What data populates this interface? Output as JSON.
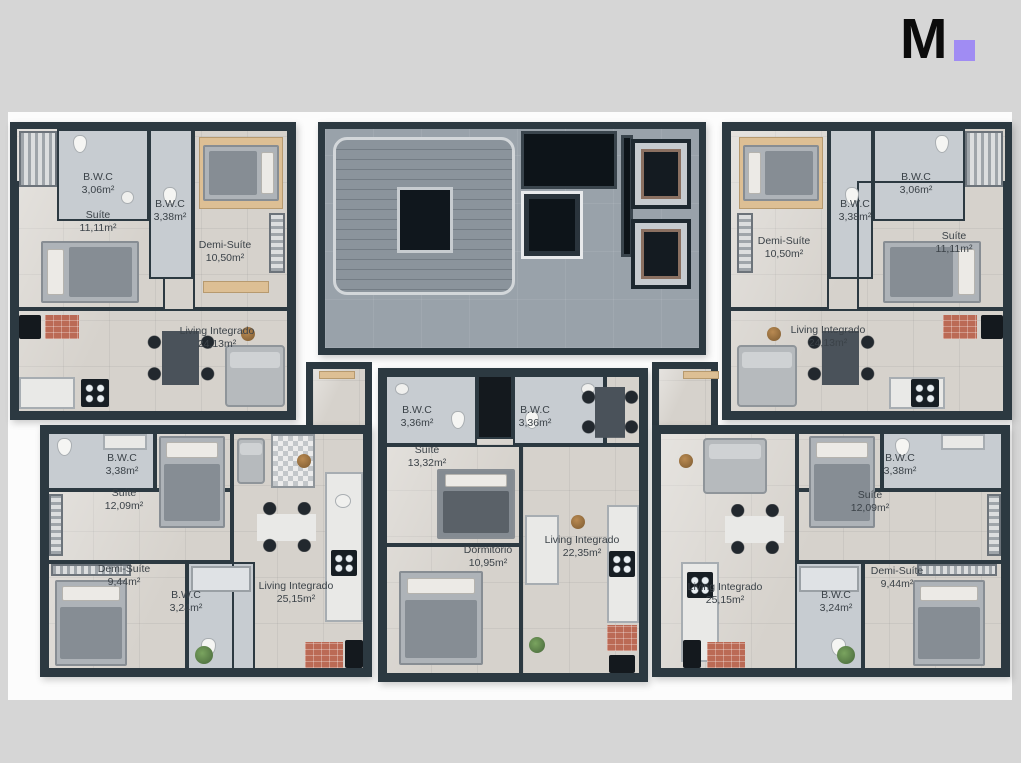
{
  "logo": {
    "letter": "M"
  },
  "theme": {
    "accent_purple": "#a08cf3",
    "wall": "#2c3941",
    "unit_floor": "#d6d2cc",
    "bath_floor": "#c7ccd1",
    "common_floor": "#99a2aa",
    "background": "#d6d6d6",
    "backdrop": "#fcfcfc",
    "label_text": "#3b4248"
  },
  "plan": {
    "units": {
      "top_left": {
        "rooms": {
          "suite": {
            "label": "Suíte",
            "area": "11,11m²"
          },
          "bwc_small": {
            "label": "B.W.C",
            "area": "3,06m²"
          },
          "bwc_large": {
            "label": "B.W.C",
            "area": "3,38m²"
          },
          "demi_suite": {
            "label": "Demi-Suíte",
            "area": "10,50m²"
          },
          "living": {
            "label": "Living Integrado",
            "area": "24,13m²"
          }
        }
      },
      "top_right": {
        "rooms": {
          "demi_suite": {
            "label": "Demi-Suíte",
            "area": "10,50m²"
          },
          "bwc_large": {
            "label": "B.W.C",
            "area": "3,38m²"
          },
          "bwc_small": {
            "label": "B.W.C",
            "area": "3,06m²"
          },
          "suite": {
            "label": "Suíte",
            "area": "11,11m²"
          },
          "living": {
            "label": "Living Integrado",
            "area": "24,13m²"
          }
        }
      },
      "bottom_left": {
        "rooms": {
          "bwc_top": {
            "label": "B.W.C",
            "area": "3,38m²"
          },
          "suite": {
            "label": "Suíte",
            "area": "12,09m²"
          },
          "demi_suite": {
            "label": "Demi-Suíte",
            "area": "9,44m²"
          },
          "bwc_bottom": {
            "label": "B.W.C",
            "area": "3,24m²"
          },
          "living": {
            "label": "Living Integrado",
            "area": "25,15m²"
          }
        }
      },
      "bottom_center": {
        "rooms": {
          "bwc_left": {
            "label": "B.W.C",
            "area": "3,36m²"
          },
          "bwc_right": {
            "label": "B.W.C",
            "area": "3,36m²"
          },
          "suite": {
            "label": "Suíte",
            "area": "13,32m²"
          },
          "dormitorio": {
            "label": "Dormitório",
            "area": "10,95m²"
          },
          "living": {
            "label": "Living Integrado",
            "area": "22,35m²"
          }
        }
      },
      "bottom_right": {
        "rooms": {
          "living": {
            "label": "Living Integrado",
            "area": "25,15m²"
          },
          "suite": {
            "label": "Suíte",
            "area": "12,09m²"
          },
          "bwc_top": {
            "label": "B.W.C",
            "area": "3,38m²"
          },
          "bwc_bottom": {
            "label": "B.W.C",
            "area": "3,24m²"
          },
          "demi_suite": {
            "label": "Demi-Suíte",
            "area": "9,44m²"
          }
        }
      }
    }
  }
}
